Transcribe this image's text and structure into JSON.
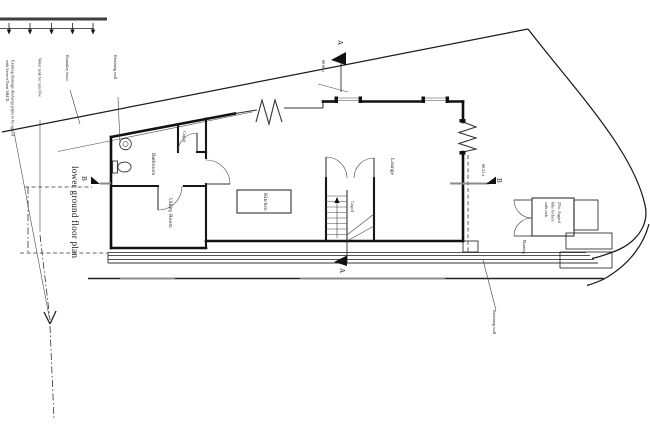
{
  "title": {
    "text": "lower ground floor plan"
  },
  "rooms": {
    "bathroom": "Bathroom",
    "cupboard": "Cup'd",
    "utility_room": "Utility Room",
    "kitchen": "Kitchen",
    "lounge": "Lounge",
    "stairs_cupboard": "Cup'd",
    "bike_store_line1": "2No. Asgard",
    "bike_store_line2": "bike lockers",
    "bike_store_line3": "with rack",
    "planting": "Planting"
  },
  "annotations": {
    "drainage_line1": "Existing drainage discharge pipes to be agreed",
    "drainage_line2": "with Severn Trent S&CD",
    "water_tank": "Water tank for rain O/w",
    "boundary_fence": "Boundary fence",
    "retaining_wall_top": "Retaining wall",
    "retaining_wall_bottom": "Retaining wall"
  },
  "markers": {
    "section_a": "A",
    "section_b": "B",
    "spot_level_a": "66.08 x",
    "spot_level_b": "66.53 x"
  },
  "colors": {
    "ink": "#1a1a1a",
    "gray": "#8a8a8a",
    "background": "#ffffff"
  }
}
